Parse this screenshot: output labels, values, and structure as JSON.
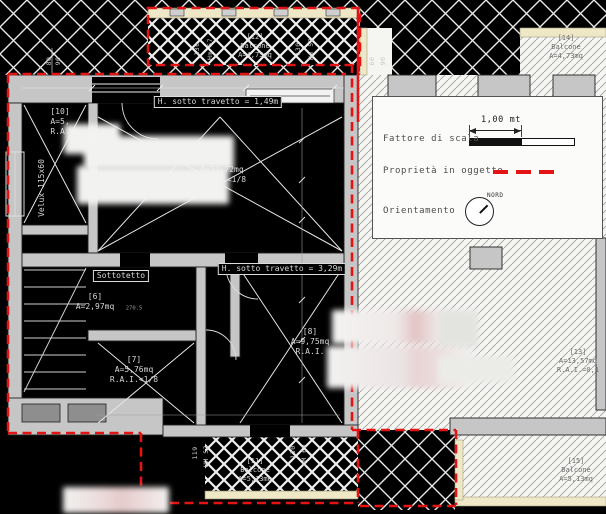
{
  "legend": {
    "scale_value": "1,00 mt",
    "scale_label": "Fattore di scala",
    "property_label": "Proprietà in oggetto",
    "orientation_label": "Orientamento",
    "north_label": "NORD"
  },
  "rooms": {
    "r10": {
      "id": "[10]",
      "area": "A=5,",
      "ra": "R.A."
    },
    "r9": {
      "id": "[9]",
      "area": "A=12,72mq",
      "ra": "R.A.I.<1/8"
    },
    "r6": {
      "id": "[6]",
      "area": "A=2,97mq"
    },
    "r7": {
      "id": "[7]",
      "area": "A=5,76mq",
      "ra": "R.A.I.<1/8"
    },
    "r8": {
      "id": "[8]",
      "area": "A=9,75mq",
      "ra": "R.A.I."
    },
    "r13": {
      "id": "[13]",
      "area": "A=13,57mq",
      "ra": "R.A.I.=0,1"
    },
    "sottotetto": "Sottotetto"
  },
  "balconies": {
    "b12": {
      "id": "[12]",
      "name": "Balcone",
      "area": "A=4,73mq"
    },
    "b14": {
      "id": "[14]",
      "name": "Balcone",
      "area": "A=4,73mq"
    },
    "b11": {
      "id": "[11]",
      "name": "Balcone",
      "area": "A=5,13mq"
    },
    "b15": {
      "id": "[15]",
      "name": "Balcone",
      "area": "A=5,13mq"
    }
  },
  "annotations": {
    "h_travetto_1": "H. sotto travetto = 1,49m",
    "h_travetto_2": "H. sotto travetto = 3,29m",
    "velux": "Velux 115x60",
    "wall_dim": "270.5"
  },
  "dimensions": {
    "top_left": [
      "80",
      "90"
    ],
    "top_mid": [
      "60",
      "90"
    ],
    "balcony_top_left": [
      "130",
      "Hm 57"
    ],
    "balcony_top_right": [
      "130",
      "Hm 57"
    ],
    "balcony_bottom_left": [
      "119",
      "HM 53"
    ],
    "balcony_bottom_right": [
      "130",
      "HM 60"
    ]
  },
  "colors": {
    "background": "#000000",
    "line": "#e8e8e8",
    "wall_fill": "#c6c6c6",
    "hatch_background": "#f5f5f2",
    "boundary_red": "#e41414",
    "balcony_trim": "#eee8c6"
  }
}
